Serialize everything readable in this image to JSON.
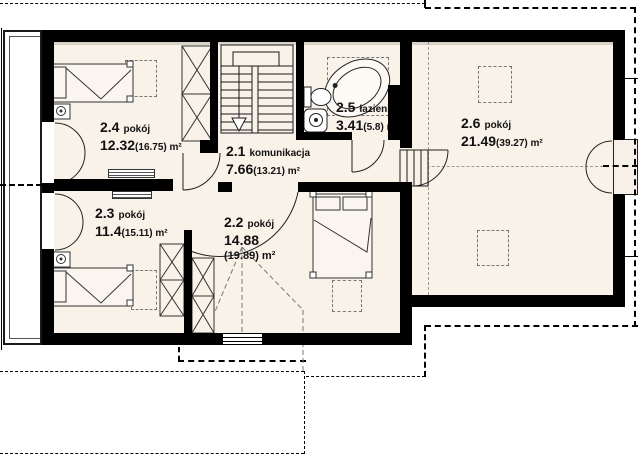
{
  "plan_type": "floor-plan-upper-storey",
  "rooms": [
    {
      "number": "2.1",
      "name": "komunikacja",
      "area": "7.66",
      "area_note": "(13.21) m²"
    },
    {
      "number": "2.2",
      "name": "pokój",
      "area": "14.88",
      "area_note": "(19.89) m²"
    },
    {
      "number": "2.3",
      "name": "pokój",
      "area": "11.4",
      "area_note": "(15.11) m²"
    },
    {
      "number": "2.4",
      "name": "pokój",
      "area": "12.32",
      "area_note": "(16.75) m²"
    },
    {
      "number": "2.5",
      "name": "łazienka",
      "area": "3.41",
      "area_note": "(5.8) m²"
    },
    {
      "number": "2.6",
      "name": "pokój",
      "area": "21.49",
      "area_note": "(39.27) m²"
    }
  ],
  "colors": {
    "wall": "#000000",
    "floor": "#f8f2e9",
    "roof_dash": "#777777"
  }
}
